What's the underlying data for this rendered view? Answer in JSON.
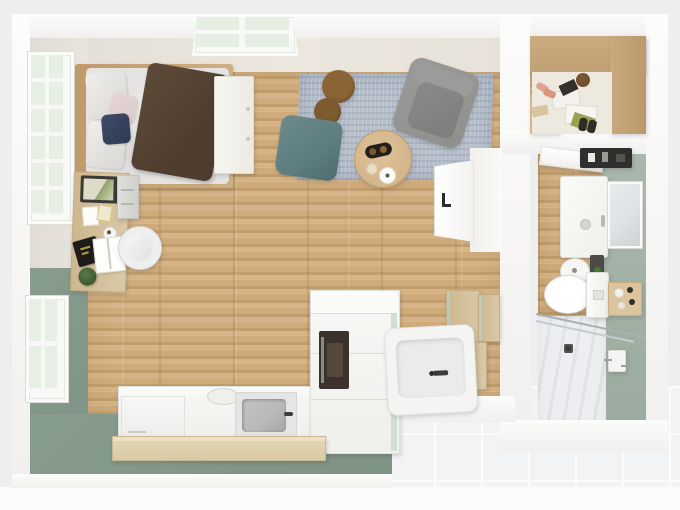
{
  "scene": {
    "type": "floorplan-3d-top-view",
    "rooms": [
      {
        "id": "main-room",
        "floor": "wood-planks",
        "walls": [
          "white-beige",
          "sage-green"
        ]
      },
      {
        "id": "walk-in-closet",
        "floor": "wood",
        "walls": [
          "white"
        ]
      },
      {
        "id": "bathroom",
        "floor": "wood-and-shower-tile",
        "walls": [
          "sage-green",
          "white"
        ]
      }
    ],
    "objects": {
      "main_room": [
        "double-bed",
        "brown-throw-blanket",
        "pillows",
        "wardrobe",
        "desk",
        "monitor",
        "desk-chair",
        "file-cabinet",
        "tall-french-window",
        "lower-window",
        "top-wall-window",
        "area-rug",
        "armchair",
        "teal-pouf",
        "round-stools",
        "coffee-table",
        "interior-door",
        "kitchen-counter",
        "dishwasher",
        "cooktop",
        "kitchen-sink",
        "oven-tall-cabinet",
        "breakfast-bar",
        "bathtub",
        "storage-cabinet",
        "wall-cabinets"
      ],
      "walk_in_closet": [
        "wardrobe-shelving",
        "clothes-and-shoes"
      ],
      "bathroom": [
        "entry-door",
        "black-wall-shelf",
        "shower-vanity-unit",
        "mirror",
        "washbasin",
        "toiletries",
        "toilet",
        "toiletry-tray",
        "shower-area",
        "glass-partition",
        "floor-drain",
        "toilet-paper-holder"
      ]
    }
  },
  "colors": {
    "bg": "#edeeef",
    "tile": "#f2f3f4",
    "tileline": "#fbfbfc",
    "green": "#879c8d",
    "bathgreen": "#a9b7ac",
    "wood": "#cfab7c",
    "wooddark": "#c29e6e",
    "woodlight": "#d6b487",
    "bedwood": "#cfae82",
    "deskwood": "#d9c9a9",
    "barwood": "#d9cba6",
    "duvet": "#e6e4e2",
    "blanket": "#5d4a39",
    "navy": "#3e4b68",
    "pink": "#dbc9ca",
    "rug": "#b6bec9",
    "armchair": "#8f8f8d",
    "armchairdark": "#7d7d7c",
    "pouf": "#5e7d7f",
    "stool": "#7b5832",
    "stooldark": "#5f401d",
    "tablewood": "#d5b58b",
    "cabwhite": "#efefec",
    "appliance": "#3a322b",
    "sinkgray": "#b7b9b8",
    "tub": "#f4f4f2",
    "tubinner": "#eaebeb",
    "mirror": "#dde2e4",
    "shelfblack": "#2f2f2d",
    "showerfloor": "#eceef0",
    "showerstripe": "#dfe2e6",
    "glass": "#e7efe4",
    "olive": "#9aa050",
    "blush": "#e0a191"
  }
}
